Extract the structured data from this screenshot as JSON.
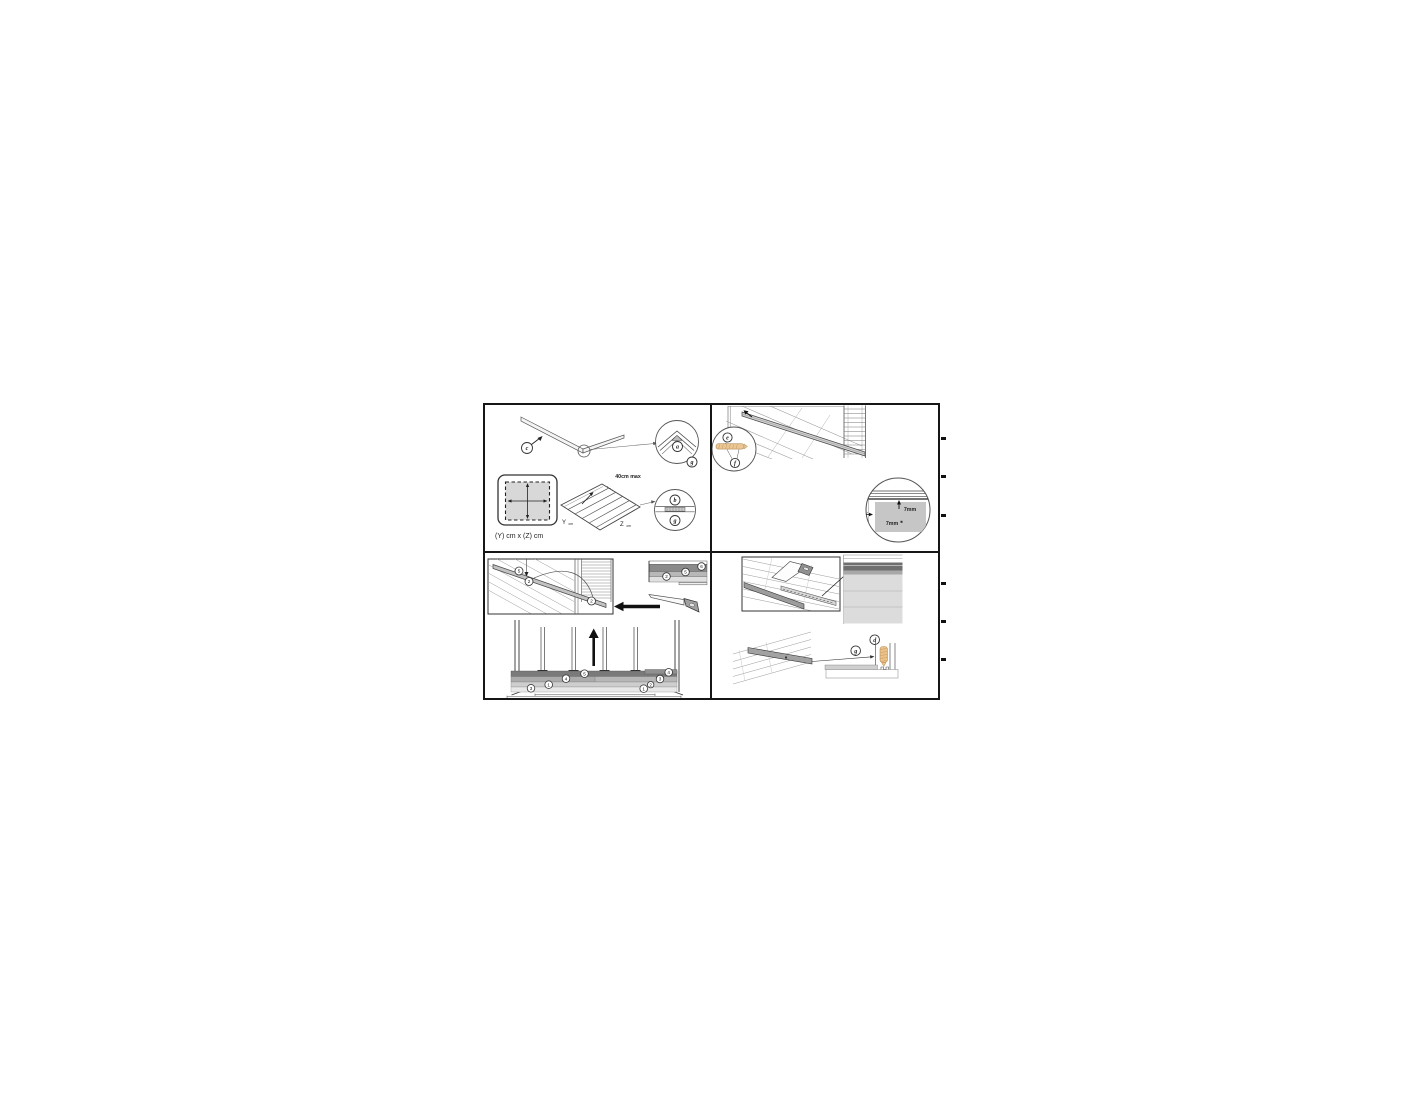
{
  "figure": {
    "panel_top_left": {
      "callout_c": "c",
      "callout_a": "a",
      "callout_g_corner": "g",
      "spacing_note": "40cm max",
      "axis_y": "Y",
      "axis_y_unit": "cm",
      "axis_z": "Z",
      "axis_z_unit": "cm",
      "dims_caption": "(Y) cm x (Z) cm",
      "callout_b": "b",
      "callout_g_joist": "g"
    },
    "panel_top_right": {
      "callout_e": "e",
      "callout_f": "f",
      "gap_top": "7mm",
      "gap_side": "7mm"
    },
    "panel_bottom_left": {
      "beam_callout_top": "5",
      "beam_callout_mid": "2",
      "beam_callout_corner": "2",
      "stack_callouts": [
        "2",
        "5",
        "6"
      ],
      "section_callouts": {
        "c5": "5",
        "c4_left": "4",
        "c4_right": "4",
        "c3_left": "3",
        "c3_right": "3",
        "c1_left": "1",
        "c1_right": "1",
        "c2_right": "2"
      }
    },
    "panel_bottom_right": {
      "callout_g": "g",
      "callout_d": "d"
    }
  }
}
